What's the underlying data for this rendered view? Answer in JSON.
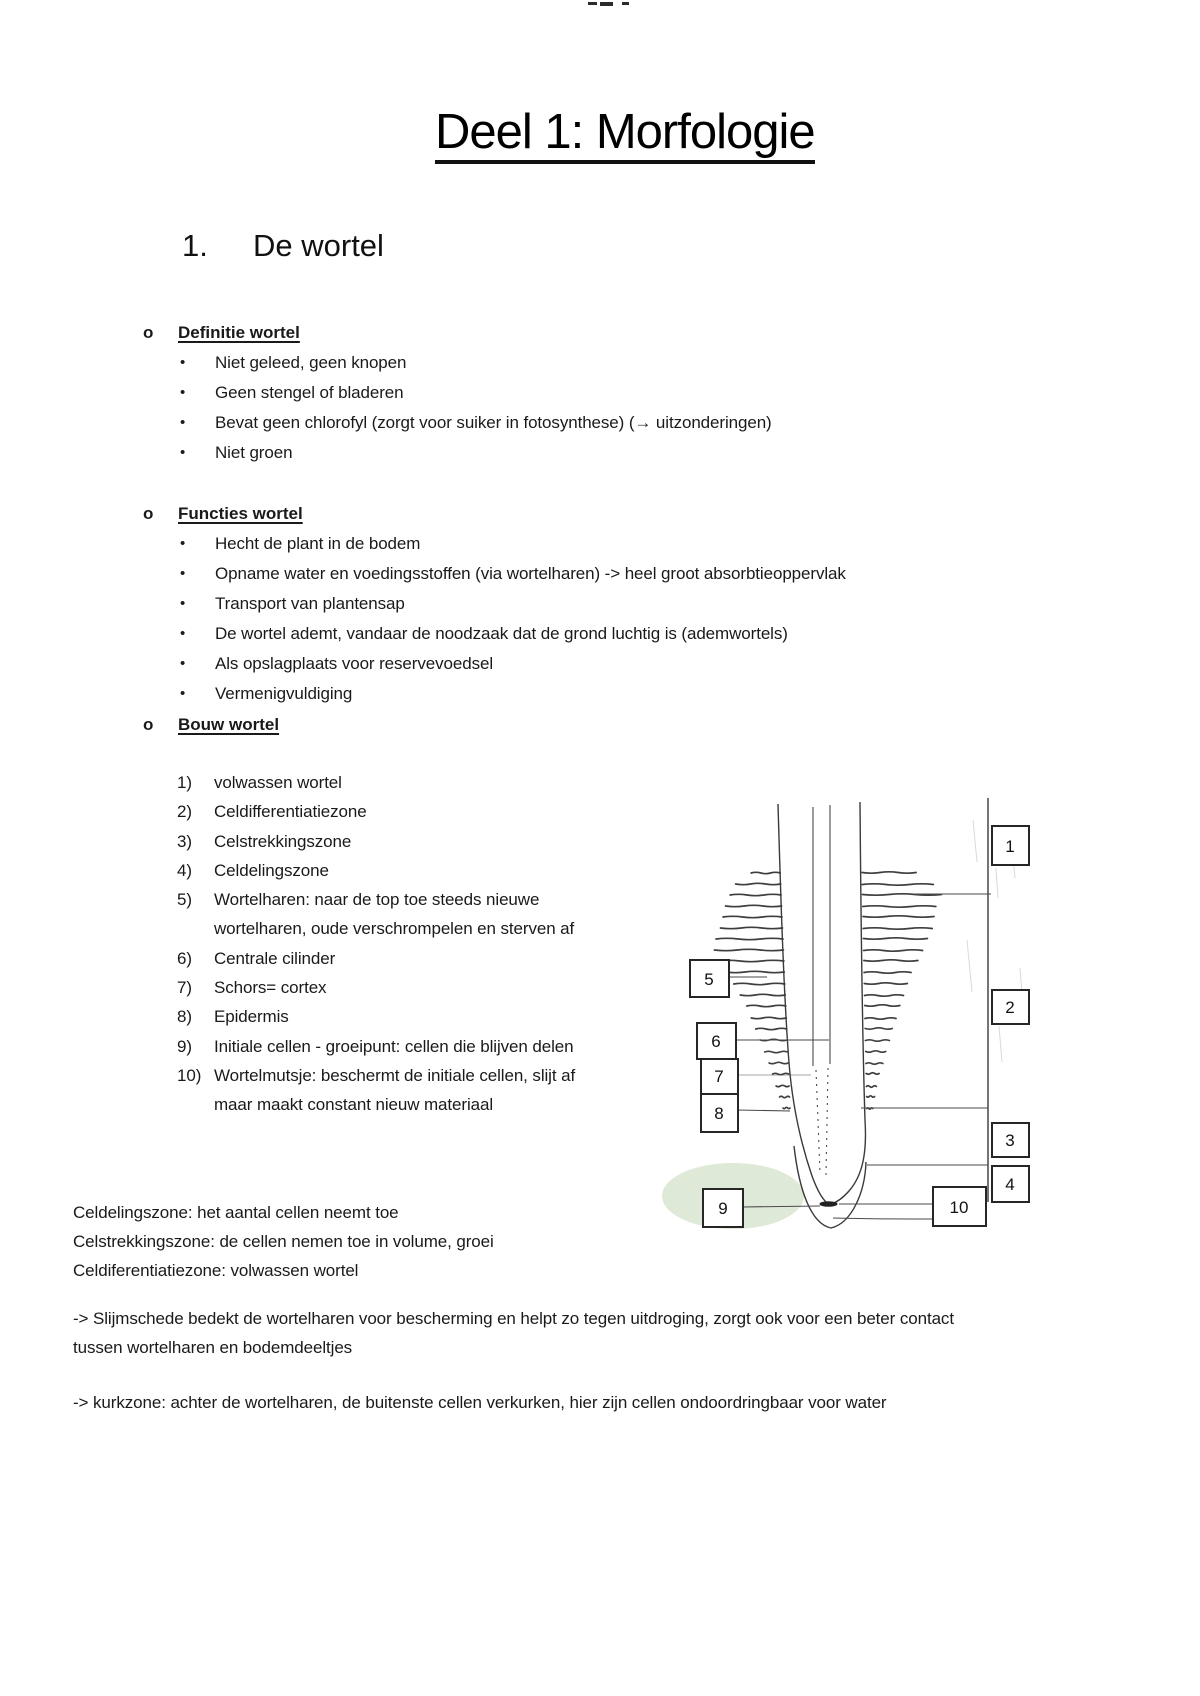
{
  "page": {
    "title": "Deel 1: Morfologie",
    "heading_number": "1.",
    "heading": "De wortel"
  },
  "glyphs": {
    "bullet": "•"
  },
  "sections": {
    "definitie": {
      "marker": "o",
      "title": "Definitie wortel",
      "bullets": [
        "Niet geleed, geen knopen",
        "Geen stengel of bladeren",
        "Bevat geen chlorofyl (zorgt voor suiker in fotosynthese) (→ uitzonderingen)",
        "Niet groen"
      ]
    },
    "functies": {
      "marker": "o",
      "title": "Functies wortel",
      "bullets": [
        "Hecht de plant in de bodem",
        "Opname water en voedingsstoffen (via wortelharen) -> heel groot absorbtieoppervlak",
        "Transport van plantensap",
        "De wortel ademt, vandaar de noodzaak dat de grond luchtig is (ademwortels)",
        "Als opslagplaats voor reservevoedsel",
        "Vermenigvuldiging"
      ]
    },
    "bouw": {
      "marker": "o",
      "title": "Bouw wortel",
      "items": [
        {
          "num": "1)",
          "text": "volwassen wortel"
        },
        {
          "num": "2)",
          "text": "Celdifferentiatiezone"
        },
        {
          "num": "3)",
          "text": "Celstrekkingszone"
        },
        {
          "num": "4)",
          "text": "Celdelingszone"
        },
        {
          "num": "5)",
          "text": "Wortelharen: naar de top toe steeds nieuwe\nwortelharen, oude verschrompelen en sterven af"
        },
        {
          "num": "6)",
          "text": "Centrale cilinder"
        },
        {
          "num": "7)",
          "text": "Schors= cortex"
        },
        {
          "num": "8)",
          "text": "Epidermis"
        },
        {
          "num": "9)",
          "text": "Initiale cellen - groeipunt: cellen die blijven delen"
        },
        {
          "num": "10)",
          "text": "Wortelmutsje: beschermt de initiale cellen, slijt af\nmaar maakt constant nieuw materiaal"
        }
      ]
    }
  },
  "zone_notes": [
    "Celdelingszone: het aantal cellen  neemt toe",
    "Celstrekkingszone: de cellen nemen toe in volume, groei",
    "Celdiferentiatiezone: volwassen wortel"
  ],
  "arrow_notes": [
    "-> Slijmschede bedekt de wortelharen voor bescherming en helpt zo tegen uitdroging, zorgt ook voor een beter contact\ntussen wortelharen en bodemdeeltjes",
    "-> kurkzone: achter de wortelharen, de buitenste cellen verkurken, hier zijn cellen ondoordringbaar voor water"
  ],
  "diagram": {
    "labels": [
      "1",
      "2",
      "3",
      "4",
      "5",
      "6",
      "7",
      "8",
      "9",
      "10"
    ],
    "highlight_color": "#dbe7d3",
    "ink_color": "#2e2e2e"
  }
}
